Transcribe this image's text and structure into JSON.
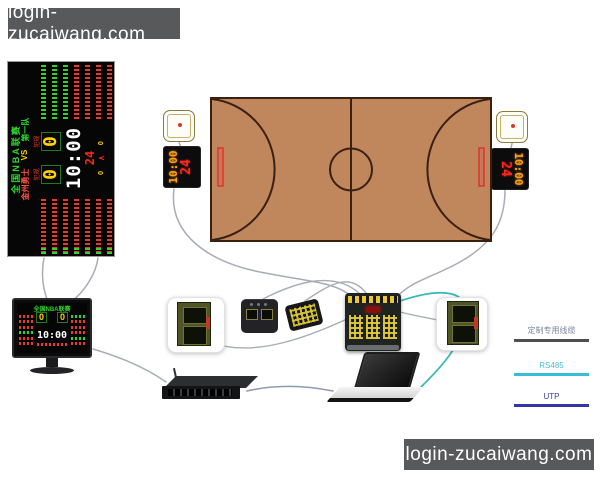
{
  "watermark": {
    "text": "login-zucaiwang.com"
  },
  "scoreboard": {
    "title": "全国NBA联赛",
    "team_home": "金州勇士",
    "vs": "VS",
    "team_away": "第一队",
    "score_home": "0",
    "score_away": "0",
    "foul_label": "犯规",
    "clock": "10:00",
    "shot_clock": "24",
    "aux_left": "0",
    "aux_caret": "∧",
    "aux_right": "0"
  },
  "shot_panel": {
    "time": "10:00",
    "seconds": "24"
  },
  "legend": {
    "items": [
      {
        "label": "定制专用线缆",
        "color": "#4e4e55"
      },
      {
        "label": "RS485",
        "color": "#38bdd6"
      },
      {
        "label": "UTP",
        "color": "#3434ae"
      }
    ]
  },
  "colors": {
    "court_fill": "#c0875d",
    "court_line": "#3a2013",
    "backboard_red": "#e03428",
    "led_yellow": "#ffd400",
    "led_red": "#ef3b2d",
    "led_green": "#2ed32e",
    "shot_time_orange": "#ffa200",
    "cable_gray": "#a8adb5",
    "cable_teal": "#35b8b4",
    "cable_utp": "#8f9ab5",
    "watermark_bg": "#58595b"
  }
}
